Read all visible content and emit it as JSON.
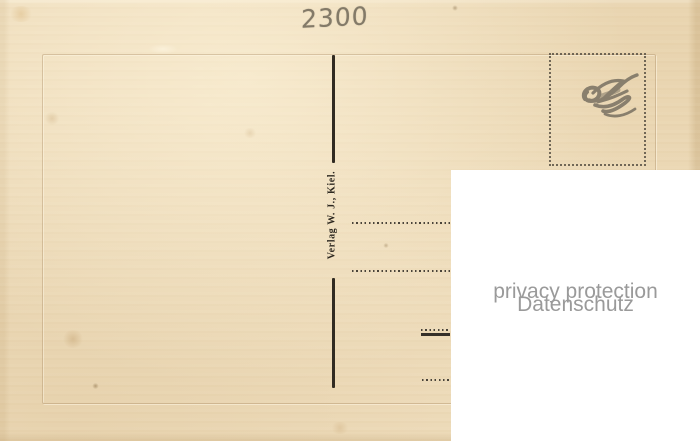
{
  "postcard": {
    "handwritten_number": "2300",
    "publisher_imprint": "Verlag W. J., Kiel."
  },
  "privacy_overlay": {
    "line1": "privacy protection",
    "line2": "Datenschutz"
  },
  "colors": {
    "paper": "#eedcbb",
    "print_ink": "#35302a",
    "pencil_gray": "#837a68",
    "overlay_background": "#ffffff",
    "overlay_text": "#9a9a9a"
  }
}
